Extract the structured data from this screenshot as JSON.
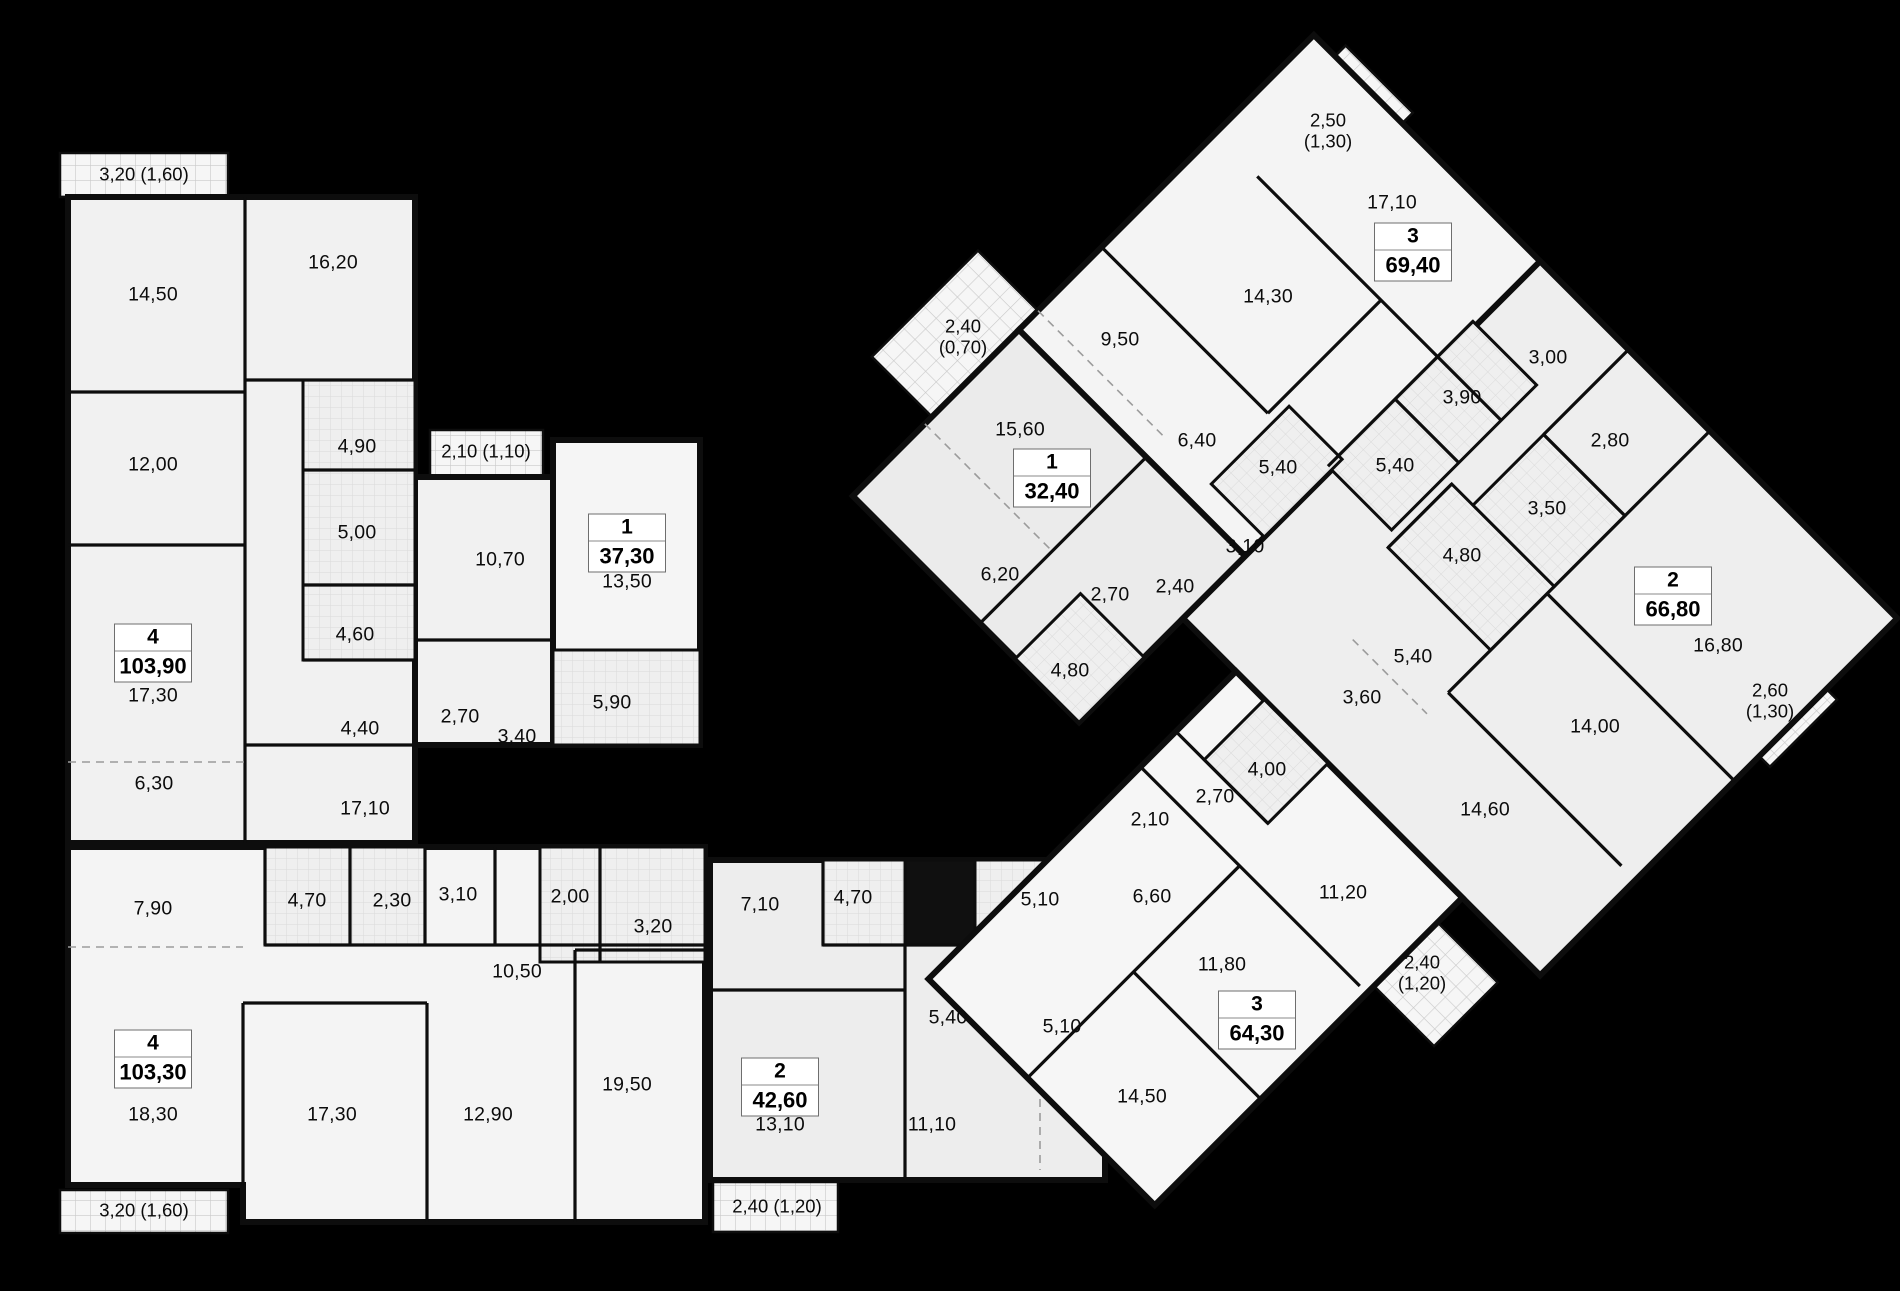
{
  "page": {
    "background": "#000000"
  },
  "colors": {
    "wall": "#0d0d0d",
    "floor": "#f2f2f2",
    "floor_dark": "#ebebeb",
    "tile_fill": "#efefef",
    "balcony_fill": "#f6f6f6",
    "grid_line": "#c9c9c9"
  },
  "apartments": [
    {
      "id": "4",
      "area": "103,90",
      "balcony": "3,20 (1,60)",
      "rooms": [
        "14,50",
        "16,20",
        "12,00",
        "4,90",
        "5,00",
        "4,60",
        "17,30",
        "4,40",
        "6,30",
        "17,10"
      ]
    },
    {
      "id": "1",
      "area": "37,30",
      "balcony": "2,10 (1,10)",
      "rooms": [
        "10,70",
        "13,50",
        "2,70",
        "3,40",
        "5,90"
      ]
    },
    {
      "id": "1",
      "area": "32,40",
      "balcony": "2,40 (0,70)",
      "rooms": [
        "15,60",
        "6,20",
        "2,70",
        "2,40",
        "4,80"
      ]
    },
    {
      "id": "3",
      "area": "69,40",
      "balcony": "2,50 (1,30)",
      "rooms": [
        "17,10",
        "14,30",
        "9,50",
        "6,40",
        "5,40",
        "3,10",
        "3,90",
        "5,40",
        "3,00"
      ]
    },
    {
      "id": "2",
      "area": "66,80",
      "balcony": "2,60 (1,30)",
      "rooms": [
        "2,80",
        "3,50",
        "4,80",
        "16,80",
        "14,00",
        "5,40",
        "3,60",
        "14,60"
      ]
    },
    {
      "id": "3",
      "area": "64,30",
      "balcony": "2,40 (1,20)",
      "rooms": [
        "5,10",
        "6,60",
        "2,10",
        "2,70",
        "4,00",
        "11,80",
        "11,20",
        "14,50"
      ]
    },
    {
      "id": "2",
      "area": "42,60",
      "balcony": "2,40 (1,20)",
      "rooms": [
        "7,10",
        "4,70",
        "5,40",
        "5,10",
        "11,10",
        "13,10"
      ]
    },
    {
      "id": "4",
      "area": "103,30",
      "balcony": "3,20 (1,60)",
      "rooms": [
        "7,90",
        "4,70",
        "2,30",
        "3,10",
        "2,00",
        "3,20",
        "10,50",
        "18,30",
        "17,30",
        "12,90",
        "19,50"
      ]
    }
  ]
}
